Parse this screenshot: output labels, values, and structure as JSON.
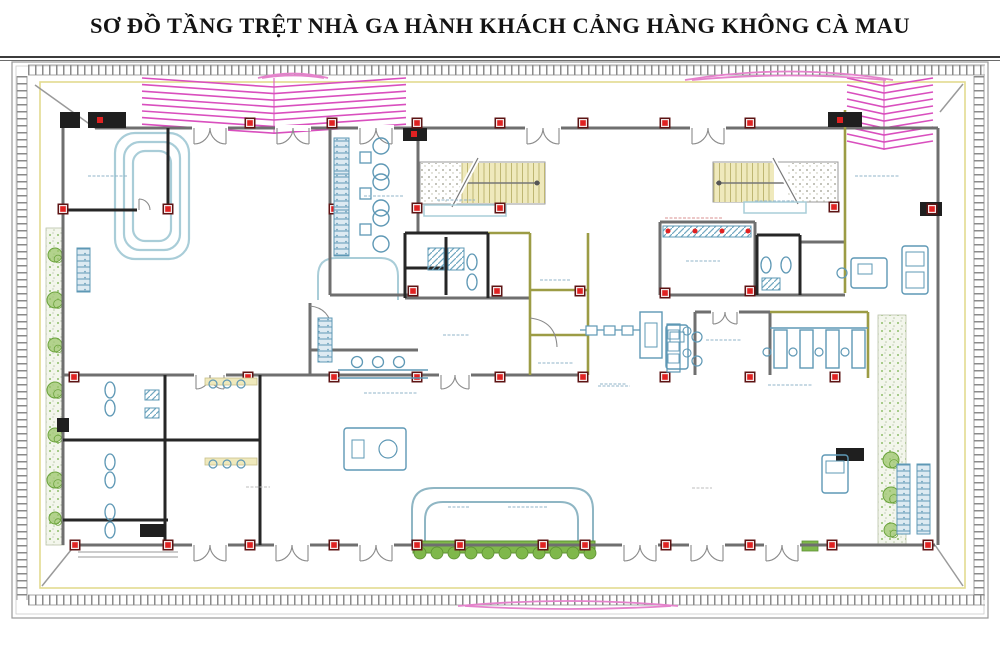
{
  "title": "SƠ ĐỒ TẦNG TRỆT NHÀ GA HÀNH KHÁCH CẢNG HÀNG KHÔNG CÀ MAU",
  "labels_illegible": true,
  "colors": {
    "wall_gray": "#6f6f6f",
    "wall_black": "#262626",
    "wall_olive": "#9c9c45",
    "column_red": "#e02222",
    "column_dark": "#5d1414",
    "carousel_blue": "#a9cdd8",
    "furniture_blue": "#5e98b5",
    "seat_fill": "#ddeaf2",
    "stair_tread": "#efe9bc",
    "stair_line": "#b9b06a",
    "pink": "#d94fbe",
    "pink_soft": "#e583cc",
    "plant_green": "#7fb84b",
    "plant_dark": "#5d8f33",
    "band_yellow": "#e3da8f",
    "tick_gray": "#8a8a8a",
    "label_blue": "#8fb3c8",
    "label_gray": "#bdbdbd",
    "label_red": "#d98f8f",
    "frame_gray": "#9a9a9a",
    "title_rule": "#3c3c3c"
  },
  "plan": {
    "frame": [
      [
        12,
        62,
        976,
        556
      ],
      [
        16,
        66,
        968,
        548
      ]
    ],
    "title_rules": [
      [
        0,
        57,
        1000,
        57,
        2
      ],
      [
        0,
        60.5,
        1000,
        60.5,
        0.8
      ]
    ],
    "tick_bands": [
      [
        28,
        70,
        985,
        70
      ],
      [
        28,
        600,
        985,
        600
      ],
      [
        22,
        76,
        22,
        600
      ],
      [
        979,
        76,
        979,
        600
      ]
    ],
    "yellow_rect": [
      40,
      82,
      925,
      506
    ],
    "diagonals": [
      [
        35,
        85,
        95,
        128
      ],
      [
        963,
        84,
        940,
        112
      ],
      [
        42,
        586,
        75,
        545
      ],
      [
        963,
        586,
        935,
        545
      ]
    ],
    "chevrons": [
      {
        "x1": 142,
        "x2": 406,
        "spine": 274,
        "y": 78,
        "rows": 8,
        "step": 6.6,
        "drop": 9
      },
      {
        "x1": 847,
        "x2": 933,
        "spine": 884,
        "y": 78,
        "rows": 10,
        "step": 7,
        "drop": 8
      }
    ],
    "lenses": [
      [
        "M258,78 Q293,69 328,78",
        "M262,78 Q293,73 324,78"
      ],
      [
        "M685,80 Q789,63 893,80",
        "M692,80 Q789,71 886,80"
      ],
      [
        "M458,606 Q568,596 678,606",
        "M465,606 Q568,612 671,606"
      ]
    ],
    "carousel": [
      [
        115,
        133,
        74,
        126,
        20
      ],
      [
        124,
        142,
        56,
        108,
        16
      ],
      [
        133,
        151,
        38,
        90,
        12
      ]
    ],
    "canopy": [
      "M412,545 L412,510 Q412,488 434,488 L571,488 Q593,488 593,510 L593,545",
      "M425,545 L425,520 Q425,502 443,502 L560,502 Q578,502 578,520 L578,545"
    ],
    "counter_curve": "M318,300 L318,276 Q318,258 336,258 L380,258 Q398,258 398,276 L398,300",
    "extra_arcs": [
      "M530,318 Q556,321 557,347",
      "M310,306 Q330,308 332,330"
    ],
    "walls_gray": [
      [
        95,
        128,
        938,
        128
      ],
      [
        75,
        545,
        935,
        545
      ],
      [
        63,
        120,
        63,
        545
      ],
      [
        938,
        128,
        938,
        545
      ],
      [
        63,
        375,
        588,
        375
      ],
      [
        330,
        128,
        330,
        295
      ],
      [
        418,
        128,
        418,
        233
      ],
      [
        330,
        295,
        418,
        295
      ],
      [
        310,
        303,
        310,
        375
      ],
      [
        310,
        350,
        418,
        350
      ],
      [
        405,
        298,
        530,
        298
      ],
      [
        660,
        222,
        660,
        295
      ],
      [
        660,
        222,
        755,
        222
      ],
      [
        755,
        222,
        755,
        295
      ],
      [
        660,
        295,
        845,
        295
      ],
      [
        800,
        242,
        845,
        242
      ],
      [
        800,
        242,
        800,
        295
      ],
      [
        695,
        312,
        695,
        375
      ],
      [
        695,
        312,
        770,
        312
      ],
      [
        770,
        312,
        770,
        375
      ]
    ],
    "walls_black": [
      [
        63,
        210,
        138,
        210
      ],
      [
        162,
        210,
        168,
        210
      ],
      [
        168,
        128,
        168,
        210
      ],
      [
        405,
        233,
        488,
        233
      ],
      [
        405,
        233,
        405,
        298
      ],
      [
        488,
        233,
        488,
        298
      ],
      [
        446,
        237,
        446,
        295
      ],
      [
        405,
        268,
        446,
        268
      ],
      [
        260,
        375,
        260,
        545
      ],
      [
        165,
        375,
        165,
        545
      ],
      [
        63,
        440,
        260,
        440
      ],
      [
        757,
        235,
        757,
        295
      ],
      [
        800,
        235,
        800,
        295
      ],
      [
        757,
        235,
        800,
        235
      ],
      [
        63,
        520,
        168,
        520
      ]
    ],
    "walls_olive": [
      [
        845,
        110,
        845,
        293
      ],
      [
        530,
        233,
        530,
        375
      ],
      [
        588,
        233,
        588,
        375
      ],
      [
        530,
        290,
        588,
        290
      ],
      [
        530,
        335,
        588,
        335
      ],
      [
        488,
        233,
        530,
        233
      ],
      [
        770,
        312,
        868,
        312
      ],
      [
        868,
        312,
        868,
        378
      ]
    ],
    "black_blocks": [
      [
        88,
        112,
        38,
        16
      ],
      [
        60,
        112,
        20,
        16
      ],
      [
        403,
        128,
        24,
        13
      ],
      [
        828,
        112,
        34,
        15
      ],
      [
        920,
        202,
        22,
        14
      ],
      [
        836,
        448,
        28,
        13
      ],
      [
        140,
        524,
        26,
        13
      ],
      [
        57,
        418,
        12,
        14
      ]
    ],
    "block_cores": [
      [
        100,
        120
      ],
      [
        414,
        134
      ],
      [
        840,
        120
      ],
      [
        930,
        209
      ]
    ],
    "columns": [
      [
        250,
        123
      ],
      [
        332,
        123
      ],
      [
        417,
        123
      ],
      [
        500,
        123
      ],
      [
        583,
        123
      ],
      [
        665,
        123
      ],
      [
        750,
        123
      ],
      [
        63,
        209
      ],
      [
        168,
        209
      ],
      [
        334,
        209
      ],
      [
        417,
        208
      ],
      [
        500,
        208
      ],
      [
        834,
        207
      ],
      [
        932,
        209
      ],
      [
        413,
        291
      ],
      [
        497,
        291
      ],
      [
        580,
        291
      ],
      [
        665,
        293
      ],
      [
        750,
        291
      ],
      [
        74,
        377
      ],
      [
        248,
        377
      ],
      [
        334,
        377
      ],
      [
        417,
        377
      ],
      [
        500,
        377
      ],
      [
        583,
        377
      ],
      [
        665,
        377
      ],
      [
        750,
        377
      ],
      [
        835,
        377
      ],
      [
        75,
        545
      ],
      [
        168,
        545
      ],
      [
        250,
        545
      ],
      [
        334,
        545
      ],
      [
        417,
        545
      ],
      [
        460,
        545
      ],
      [
        543,
        545
      ],
      [
        585,
        545
      ],
      [
        666,
        545
      ],
      [
        750,
        545
      ],
      [
        832,
        545
      ],
      [
        928,
        545
      ]
    ],
    "doors_double": [
      [
        210,
        128,
        16
      ],
      [
        293,
        128,
        16
      ],
      [
        376,
        128,
        16
      ],
      [
        543,
        128,
        16
      ],
      [
        708,
        128,
        16
      ],
      [
        210,
        545,
        16
      ],
      [
        292,
        545,
        16
      ],
      [
        376,
        545,
        16
      ],
      [
        640,
        545,
        16
      ],
      [
        707,
        545,
        16
      ],
      [
        782,
        545,
        16
      ],
      [
        210,
        375,
        14
      ],
      [
        455,
        375,
        14
      ],
      [
        725,
        312,
        12
      ]
    ],
    "doors_single": [
      [
        150,
        210,
        11
      ]
    ],
    "stairs": [
      {
        "box": [
          420,
          162,
          125,
          42
        ],
        "stip": [
          421,
          163,
          40,
          40
        ],
        "tread": [
          462,
          163,
          83,
          40
        ],
        "rail": [
          462,
          183,
          540,
          183
        ],
        "dot": [
          537,
          183
        ],
        "brk": [
          452,
          207,
          478,
          158
        ],
        "under": [
          424,
          205,
          82,
          11
        ]
      },
      {
        "box": [
          713,
          162,
          125,
          40
        ],
        "stip": [
          788,
          163,
          49,
          39
        ],
        "tread": [
          714,
          163,
          60,
          39
        ],
        "rail": [
          716,
          183,
          786,
          183
        ],
        "dot": [
          719,
          183
        ],
        "brk": [
          773,
          158,
          798,
          204
        ],
        "under": [
          744,
          202,
          62,
          11
        ]
      }
    ],
    "plant_strips": [
      [
        46,
        228,
        18,
        317
      ],
      [
        878,
        315,
        28,
        230
      ]
    ],
    "plant_blobs": [
      [
        55,
        255,
        7
      ],
      [
        55,
        300,
        8
      ],
      [
        55,
        345,
        7
      ],
      [
        55,
        390,
        8
      ],
      [
        55,
        435,
        7
      ],
      [
        55,
        480,
        8
      ],
      [
        55,
        518,
        6
      ],
      [
        891,
        460,
        8
      ],
      [
        891,
        495,
        8
      ],
      [
        891,
        530,
        7
      ]
    ],
    "hedge": {
      "base": [
        413,
        541,
        182,
        12
      ],
      "scallops_y": 553,
      "scallops": [
        420,
        437,
        454,
        471,
        488,
        505,
        522,
        539,
        556,
        573,
        590
      ],
      "extra": [
        802,
        541,
        16,
        10
      ]
    },
    "benches": [
      [
        334,
        138,
        15,
        46
      ],
      [
        334,
        174,
        15,
        46
      ],
      [
        334,
        210,
        15,
        46
      ],
      [
        318,
        318,
        14,
        44
      ],
      [
        77,
        248,
        13,
        44
      ],
      [
        897,
        464,
        13,
        70
      ],
      [
        917,
        464,
        13,
        70
      ]
    ],
    "tables_sq": [
      [
        360,
        152,
        11,
        11
      ],
      [
        360,
        188,
        11,
        11
      ],
      [
        360,
        224,
        11,
        11
      ]
    ],
    "tables_round": [
      [
        381,
        146
      ],
      [
        381,
        172
      ],
      [
        381,
        182
      ],
      [
        381,
        208
      ],
      [
        381,
        218
      ],
      [
        381,
        244
      ]
    ],
    "stools": [
      [
        357,
        362
      ],
      [
        378,
        362
      ],
      [
        399,
        362
      ]
    ],
    "counter_lines": [
      [
        338,
        370,
        428,
        370
      ],
      [
        338,
        378,
        428,
        378
      ],
      [
        770,
        328,
        868,
        328
      ]
    ],
    "booths": {
      "xs": [
        774,
        800,
        826,
        852
      ],
      "y": 330,
      "w": 13,
      "h": 38,
      "chair_y": 352
    },
    "desk_rects": [
      [
        666,
        325,
        22,
        44
      ],
      [
        851,
        258,
        36,
        30
      ],
      [
        902,
        246,
        26,
        48
      ],
      [
        822,
        455,
        26,
        38
      ],
      [
        344,
        428,
        62,
        42
      ]
    ],
    "desk_inner": [
      [
        670,
        332,
        14,
        10
      ],
      [
        858,
        264,
        14,
        10
      ],
      [
        906,
        252,
        18,
        14
      ],
      [
        906,
        272,
        18,
        16
      ],
      [
        826,
        461,
        18,
        12
      ],
      [
        352,
        440,
        12,
        18
      ]
    ],
    "desk_chairs": [
      [
        697,
        337,
        5
      ],
      [
        697,
        361,
        5
      ],
      [
        842,
        273,
        5
      ],
      [
        388,
        449,
        9
      ]
    ],
    "scanner": {
      "squares": [
        [
          586,
          326
        ],
        [
          604,
          326
        ],
        [
          622,
          326
        ]
      ],
      "sq_w": 11,
      "sq_h": 9,
      "belt": [
        580,
        330,
        640,
        330
      ],
      "outer": [
        640,
        312,
        22,
        46
      ],
      "inner": [
        645,
        323,
        12,
        24
      ],
      "unit": [
        667,
        324,
        13,
        48
      ],
      "unit_inner": [
        [
          668,
          330,
          11,
          9
        ],
        [
          668,
          342,
          11,
          9
        ],
        [
          668,
          354,
          11,
          9
        ]
      ],
      "circles": [
        [
          687,
          331
        ],
        [
          687,
          353
        ]
      ]
    },
    "check_band": {
      "rect": [
        663,
        226,
        88,
        11
      ],
      "dots": [
        [
          668,
          231
        ],
        [
          695,
          231
        ],
        [
          722,
          231
        ],
        [
          748,
          231
        ]
      ]
    },
    "wc_ovals": [
      [
        110,
        390
      ],
      [
        110,
        408
      ],
      [
        110,
        462
      ],
      [
        110,
        480
      ],
      [
        110,
        512
      ],
      [
        110,
        530
      ],
      [
        472,
        262
      ],
      [
        472,
        282
      ],
      [
        766,
        265
      ],
      [
        786,
        265
      ]
    ],
    "wc_hatch": [
      [
        428,
        248,
        16,
        22
      ],
      [
        448,
        248,
        16,
        22
      ],
      [
        762,
        278,
        18,
        12
      ],
      [
        145,
        390,
        14,
        10
      ],
      [
        145,
        408,
        14,
        10
      ]
    ],
    "sinks": [
      [
        213,
        384
      ],
      [
        227,
        384
      ],
      [
        241,
        384
      ],
      [
        213,
        464
      ],
      [
        227,
        464
      ],
      [
        241,
        464
      ]
    ],
    "counters_yellow": [
      [
        205,
        378,
        52,
        7
      ],
      [
        205,
        458,
        52,
        7
      ]
    ],
    "steps": [
      [
        78,
        552,
        178,
        552
      ],
      [
        78,
        557,
        178,
        557
      ]
    ],
    "labels": [
      [
        88,
        176,
        40,
        "b"
      ],
      [
        364,
        196,
        40,
        "b"
      ],
      [
        437,
        200,
        38,
        "b"
      ],
      [
        755,
        201,
        40,
        "b"
      ],
      [
        855,
        176,
        44,
        "b"
      ],
      [
        686,
        261,
        34,
        "b"
      ],
      [
        540,
        280,
        30,
        "b"
      ],
      [
        443,
        335,
        26,
        "b"
      ],
      [
        538,
        363,
        36,
        "b"
      ],
      [
        600,
        384,
        26,
        "b"
      ],
      [
        706,
        340,
        36,
        "b"
      ],
      [
        768,
        385,
        44,
        "b"
      ],
      [
        598,
        386,
        32,
        "b"
      ],
      [
        448,
        507,
        22,
        "b"
      ],
      [
        508,
        507,
        40,
        "b"
      ],
      [
        246,
        487,
        24,
        "g"
      ],
      [
        692,
        488,
        20,
        "g"
      ],
      [
        364,
        393,
        54,
        "b"
      ],
      [
        665,
        218,
        58,
        "r"
      ]
    ]
  }
}
